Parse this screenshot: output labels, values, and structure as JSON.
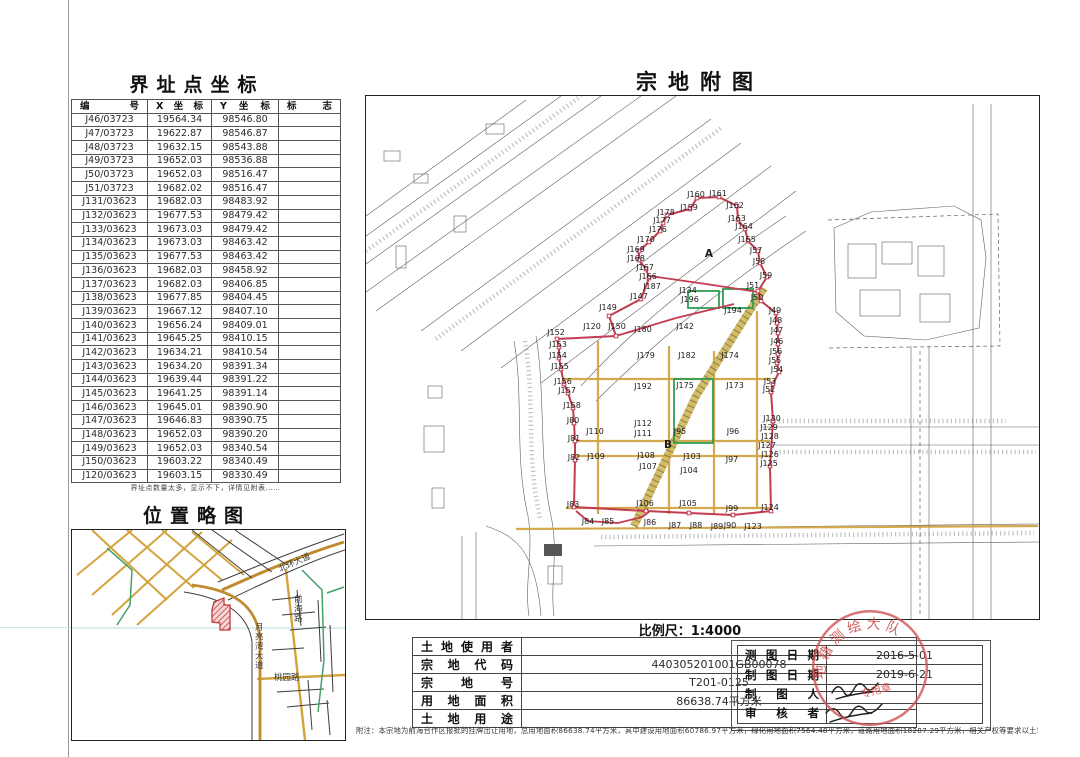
{
  "coord_table": {
    "title": "界址点坐标",
    "headers": [
      "编号",
      "X坐标",
      "Y坐标",
      "标志"
    ],
    "rows": [
      [
        "J46/03723",
        "19564.34",
        "98546.80"
      ],
      [
        "J47/03723",
        "19622.87",
        "98546.87"
      ],
      [
        "J48/03723",
        "19632.15",
        "98543.88"
      ],
      [
        "J49/03723",
        "19652.03",
        "98536.88"
      ],
      [
        "J50/03723",
        "19652.03",
        "98516.47"
      ],
      [
        "J51/03723",
        "19682.02",
        "98516.47"
      ],
      [
        "J131/03623",
        "19682.03",
        "98483.92"
      ],
      [
        "J132/03623",
        "19677.53",
        "98479.42"
      ],
      [
        "J133/03623",
        "19673.03",
        "98479.42"
      ],
      [
        "J134/03623",
        "19673.03",
        "98463.42"
      ],
      [
        "J135/03623",
        "19677.53",
        "98463.42"
      ],
      [
        "J136/03623",
        "19682.03",
        "98458.92"
      ],
      [
        "J137/03623",
        "19682.03",
        "98406.85"
      ],
      [
        "J138/03623",
        "19677.85",
        "98404.45"
      ],
      [
        "J139/03623",
        "19667.12",
        "98407.10"
      ],
      [
        "J140/03623",
        "19656.24",
        "98409.01"
      ],
      [
        "J141/03623",
        "19645.25",
        "98410.15"
      ],
      [
        "J142/03623",
        "19634.21",
        "98410.54"
      ],
      [
        "J143/03623",
        "19634.20",
        "98391.34"
      ],
      [
        "J144/03623",
        "19639.44",
        "98391.22"
      ],
      [
        "J145/03623",
        "19641.25",
        "98391.14"
      ],
      [
        "J146/03623",
        "19645.01",
        "98390.90"
      ],
      [
        "J147/03623",
        "19646.83",
        "98390.75"
      ],
      [
        "J148/03623",
        "19652.03",
        "98390.20"
      ],
      [
        "J149/03623",
        "19652.03",
        "98340.54"
      ],
      [
        "J150/03623",
        "19603.22",
        "98340.49"
      ],
      [
        "J120/03623",
        "19603.15",
        "98330.49"
      ]
    ],
    "note": "界址点数量太多，显示不下，详情见附表……"
  },
  "location_map": {
    "title": "位置略图",
    "labels": [
      {
        "text": "北环大道",
        "x": 208,
        "y": 42,
        "rotate": -24
      },
      {
        "text": "月亮湾大道",
        "x": 183,
        "y": 100,
        "vertical": true
      },
      {
        "text": "前海路",
        "x": 222,
        "y": 72,
        "vertical": true
      },
      {
        "text": "桃园路",
        "x": 202,
        "y": 150
      }
    ]
  },
  "parcel_map": {
    "title": "宗地附图",
    "scale_label": "比例尺：1:4000",
    "region_labels": [
      {
        "text": "A",
        "x": 343,
        "y": 161
      },
      {
        "text": "B",
        "x": 302,
        "y": 352
      }
    ],
    "point_labels": [
      [
        "J160",
        330,
        101
      ],
      [
        "J161",
        352,
        100
      ],
      [
        "J159",
        323,
        114
      ],
      [
        "J162",
        369,
        112
      ],
      [
        "J163",
        371,
        125
      ],
      [
        "J164",
        378,
        133
      ],
      [
        "J165",
        381,
        146
      ],
      [
        "J57",
        390,
        157
      ],
      [
        "J58",
        393,
        168
      ],
      [
        "J59",
        400,
        182
      ],
      [
        "J178",
        300,
        119
      ],
      [
        "J177",
        296,
        127
      ],
      [
        "J176",
        292,
        136
      ],
      [
        "J170",
        280,
        146
      ],
      [
        "J169",
        270,
        156
      ],
      [
        "J168",
        270,
        165
      ],
      [
        "J167",
        279,
        174
      ],
      [
        "J166",
        282,
        183
      ],
      [
        "J187",
        286,
        193
      ],
      [
        "J147",
        273,
        203
      ],
      [
        "J149",
        242,
        214
      ],
      [
        "J120",
        226,
        233
      ],
      [
        "J150",
        251,
        233
      ],
      [
        "J152",
        190,
        239
      ],
      [
        "J153",
        192,
        251
      ],
      [
        "J154",
        192,
        262
      ],
      [
        "J155",
        194,
        273
      ],
      [
        "J156",
        197,
        288
      ],
      [
        "J157",
        201,
        297
      ],
      [
        "J158",
        206,
        312
      ],
      [
        "J80",
        207,
        327
      ],
      [
        "J81",
        208,
        345
      ],
      [
        "J82",
        208,
        364
      ],
      [
        "J83",
        207,
        411
      ],
      [
        "J84",
        222,
        428
      ],
      [
        "J85",
        242,
        428
      ],
      [
        "J86",
        284,
        429
      ],
      [
        "J87",
        309,
        432
      ],
      [
        "J88",
        330,
        432
      ],
      [
        "J89",
        351,
        433
      ],
      [
        "J90",
        364,
        432
      ],
      [
        "J123",
        387,
        433
      ],
      [
        "J124",
        404,
        414
      ],
      [
        "J99",
        366,
        415
      ],
      [
        "J105",
        322,
        410
      ],
      [
        "J106",
        279,
        410
      ],
      [
        "J103",
        326,
        363
      ],
      [
        "J104",
        323,
        377
      ],
      [
        "J97",
        366,
        366
      ],
      [
        "J96",
        367,
        338
      ],
      [
        "J95",
        314,
        338
      ],
      [
        "J107",
        282,
        373
      ],
      [
        "J108",
        280,
        362
      ],
      [
        "J109",
        230,
        363
      ],
      [
        "J110",
        229,
        338
      ],
      [
        "J111",
        277,
        340
      ],
      [
        "J112",
        277,
        330
      ],
      [
        "J175",
        319,
        292
      ],
      [
        "J173",
        369,
        292
      ],
      [
        "J192",
        277,
        293
      ],
      [
        "J179",
        280,
        262
      ],
      [
        "J180",
        277,
        236
      ],
      [
        "J182",
        321,
        262
      ],
      [
        "J142",
        319,
        233
      ],
      [
        "J174",
        364,
        262
      ],
      [
        "J194",
        367,
        217
      ],
      [
        "J134",
        322,
        197
      ],
      [
        "J196",
        324,
        206
      ],
      [
        "J51",
        387,
        192
      ],
      [
        "J50",
        391,
        204
      ],
      [
        "J49",
        409,
        217
      ],
      [
        "J48",
        410,
        227
      ],
      [
        "J47",
        411,
        237
      ],
      [
        "J46",
        411,
        248
      ],
      [
        "J56",
        410,
        258
      ],
      [
        "J55",
        409,
        267
      ],
      [
        "J54",
        411,
        276
      ],
      [
        "J53",
        404,
        288
      ],
      [
        "J52",
        403,
        296
      ],
      [
        "J130",
        406,
        325
      ],
      [
        "J129",
        403,
        334
      ],
      [
        "J128",
        404,
        343
      ],
      [
        "J127",
        401,
        352
      ],
      [
        "J126",
        404,
        361
      ],
      [
        "J125",
        403,
        370
      ]
    ],
    "boundary_points": [
      [
        331,
        102
      ],
      [
        353,
        101
      ],
      [
        371,
        110
      ],
      [
        372,
        124
      ],
      [
        379,
        133
      ],
      [
        382,
        145
      ],
      [
        392,
        155
      ],
      [
        394,
        167
      ],
      [
        401,
        181
      ],
      [
        392,
        195
      ],
      [
        395,
        205
      ],
      [
        410,
        217
      ],
      [
        411,
        227
      ],
      [
        412,
        237
      ],
      [
        412,
        248
      ],
      [
        412,
        258
      ],
      [
        411,
        267
      ],
      [
        413,
        276
      ],
      [
        407,
        288
      ],
      [
        405,
        296
      ],
      [
        407,
        325
      ],
      [
        404,
        370
      ],
      [
        405,
        415
      ],
      [
        367,
        419
      ],
      [
        323,
        417
      ],
      [
        280,
        415
      ],
      [
        208,
        411
      ],
      [
        209,
        364
      ],
      [
        209,
        345
      ],
      [
        208,
        327
      ],
      [
        207,
        312
      ],
      [
        202,
        297
      ],
      [
        198,
        288
      ],
      [
        195,
        273
      ],
      [
        193,
        262
      ],
      [
        193,
        251
      ],
      [
        191,
        243
      ],
      [
        250,
        240
      ],
      [
        243,
        220
      ],
      [
        275,
        203
      ],
      [
        283,
        182
      ],
      [
        280,
        173
      ],
      [
        273,
        164
      ],
      [
        273,
        155
      ],
      [
        283,
        146
      ],
      [
        294,
        135
      ],
      [
        297,
        127
      ],
      [
        301,
        119
      ],
      [
        324,
        113
      ]
    ]
  },
  "info_table": {
    "rows": [
      {
        "label": "土地使用者",
        "value": ""
      },
      {
        "label": "宗地代码",
        "value": "440305201001GB00078"
      },
      {
        "label": "宗地号",
        "value": "T201-0125"
      },
      {
        "label": "用地面积",
        "value": "86638.74平方米"
      },
      {
        "label": "土地用途",
        "value": ""
      }
    ]
  },
  "survey_table": {
    "rows": [
      {
        "label": "测图日期",
        "value": "2016-5-01"
      },
      {
        "label": "制图日期",
        "value": "2019-6-21"
      },
      {
        "label": "制图人",
        "value": ""
      },
      {
        "label": "审核者",
        "value": ""
      }
    ]
  },
  "seal": {
    "arc_text": "地籍测绘大队",
    "inner_text": "专用章"
  },
  "footnote": "附注：本宗地为前海合作区报批的挂牌出让用地，总用地面积86638.74平方米，其中建设用地面积60786.97平方米，绿化用地面积7564.48平方米，道路用地面积18287.29平方米，相关产权等要求以土地出让合同为准。",
  "colors": {
    "boundary_red": "#c23b50",
    "road_yellow": "#d2a544",
    "green": "#2f9e53",
    "seal_red": "#cf5252"
  }
}
